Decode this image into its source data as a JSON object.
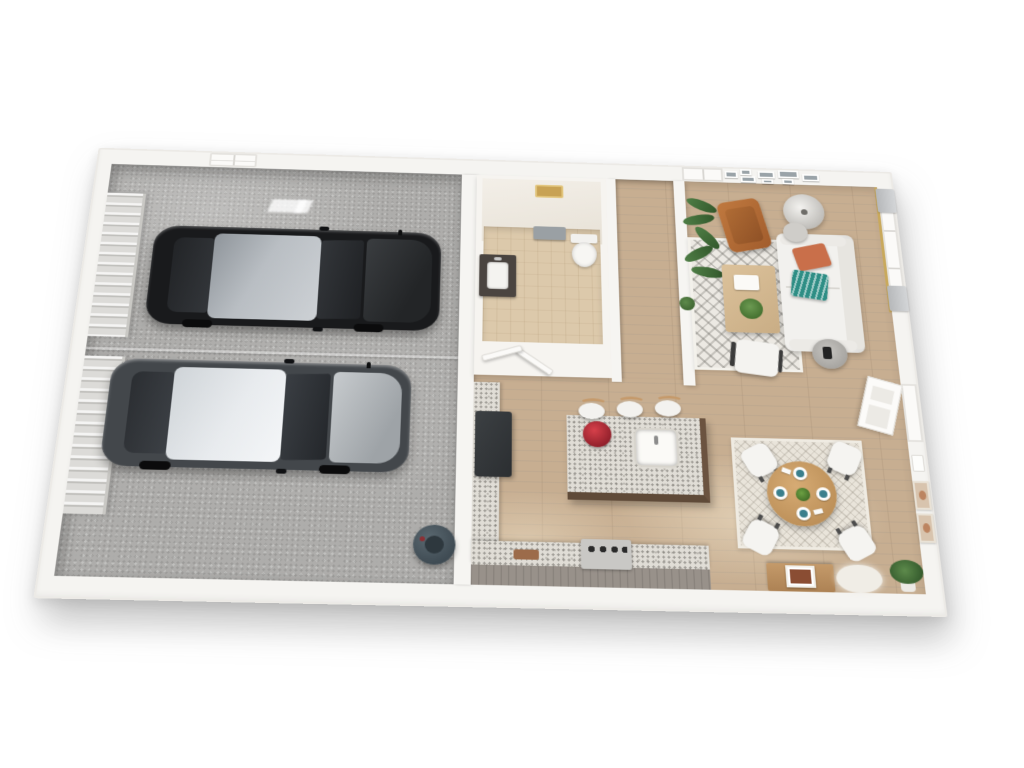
{
  "image_type": "3d-floor-plan-render",
  "view": "isometric top-down cutaway of a single-level unit, white background, no text labels",
  "palette": {
    "color-wall": "#f5f4f1",
    "color-concrete": "#aeadab",
    "color-wood": "#c7ae91",
    "color-granite": "#e0ddd6",
    "color-cabinet": "#98918a",
    "color-island-base": "#5f4a38",
    "color-sofa": "#f2f1ee",
    "color-pillow-rust": "#c96f4a",
    "color-pillow-teal": "#2e8e85",
    "color-leather-chair": "#b2663a",
    "color-dining-table": "#c89a66",
    "color-plant": "#4e7d45",
    "color-car1-body": "#191a1c",
    "color-car2-body": "#43474b",
    "color-curtain": "#b6b8ba",
    "color-curtain-rod": "#c9a95c"
  },
  "rooms": [
    {
      "name": "garage",
      "floor": "concrete",
      "items": [
        "garage-door-panel-a",
        "garage-door-panel-b",
        "ceiling-skylight",
        "black-sedan",
        "gray-sedan",
        "shop-vacuum",
        "floor-light-reflection"
      ]
    },
    {
      "name": "bathroom",
      "floor": "tan-tile",
      "items": [
        "vanity-with-sink",
        "mirror",
        "towel-rack-gray-towel",
        "toilet",
        "open-door-1",
        "open-door-2",
        "gold-storage-box"
      ]
    },
    {
      "name": "staircase",
      "floor": "wood-treads",
      "items": [
        "stair-treads",
        "white-stringer-walls"
      ]
    },
    {
      "name": "kitchen",
      "floor": "wood",
      "items": [
        "granite-left-counter",
        "dark-refrigerator",
        "granite-bottom-counter",
        "gas-range",
        "cutting-board",
        "granite-island",
        "undermount-sink",
        "red-fruit-bowl",
        "bar-stool",
        "bar-stool",
        "bar-stool",
        "gray-cabinet-band"
      ]
    },
    {
      "name": "living-room",
      "floor": "wood",
      "items": [
        "patterned-area-rug",
        "white-sofa",
        "rust-pillow",
        "teal-patterned-pillow",
        "wood-coffee-table",
        "book-stack",
        "green-bowl-plant",
        "cognac-leather-armchair",
        "round-floor-lamp",
        "gray-lamp-table",
        "white-slipper-chair",
        "round-side-table",
        "tall-palm-plant",
        "small-potted-plant",
        "gallery-wall-frames",
        "window-with-curtains-top",
        "windows-with-curtains-right",
        "gold-curtain-rod"
      ]
    },
    {
      "name": "dining-area",
      "floor": "wood",
      "items": [
        "woven-area-rug",
        "round-wood-table",
        "green-centerpiece",
        "place-setting-teal-bowl",
        "place-setting-teal-bowl",
        "place-setting-teal-bowl",
        "place-setting-teal-bowl",
        "white-chair",
        "white-chair",
        "white-chair",
        "white-chair",
        "wood-console",
        "framed-art-on-console",
        "flokati-rug",
        "corner-potted-plant"
      ]
    },
    {
      "name": "entry",
      "items": [
        "white-panel-door-open",
        "door-frame",
        "thermostat-panel",
        "beige-wall-art",
        "beige-wall-art"
      ]
    }
  ],
  "counts": {
    "cars": 2,
    "bar_stools": 3,
    "dining_chairs": 4,
    "gallery_frames": 8,
    "wall_art_right": 2
  }
}
